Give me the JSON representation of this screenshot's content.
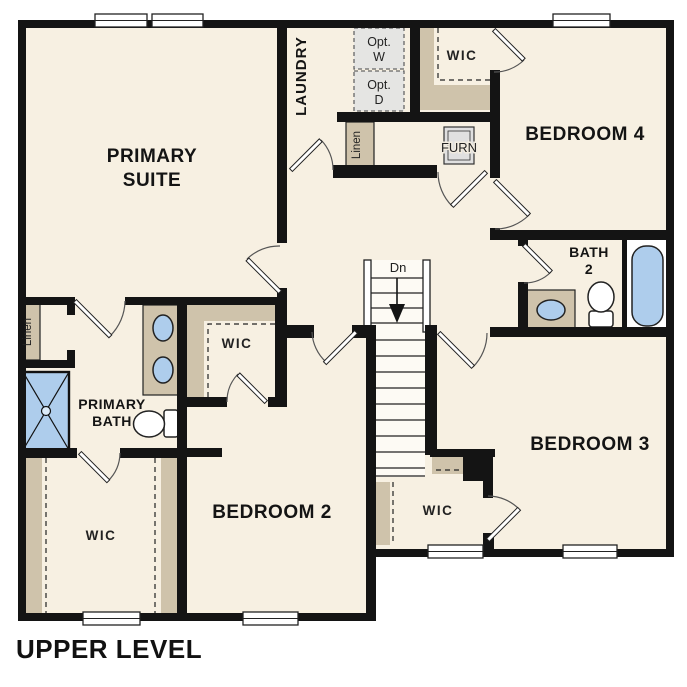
{
  "title": "UPPER LEVEL",
  "colors": {
    "floor": "#f7f0e2",
    "wall": "#141414",
    "shelf_tan": "#cfc3ab",
    "fixture_blue": "#aecdec",
    "optional_gray": "#e5e5e3",
    "stair_fill": "#fdfaf4"
  },
  "rooms": {
    "primary_suite_line1": "PRIMARY",
    "primary_suite_line2": "SUITE",
    "laundry": "LAUNDRY",
    "wic_top": "WIC",
    "bedroom4": "BEDROOM 4",
    "linen_laundry": "Linen",
    "bath2_line1": "BATH",
    "bath2_line2": "2",
    "linen_hall": "Linen",
    "wic_primary_mid": "WIC",
    "primary_bath_line1": "PRIMARY",
    "primary_bath_line2": "BATH",
    "bedroom2": "BEDROOM 2",
    "wic_lower_left": "WIC",
    "bedroom3": "BEDROOM 3",
    "wic_lower_center": "WIC"
  },
  "fixtures": {
    "opt_washer_line1": "Opt.",
    "opt_washer_line2": "W",
    "opt_dryer_line1": "Opt.",
    "opt_dryer_line2": "D",
    "furnace": "FURN",
    "stair_direction": "Dn"
  }
}
